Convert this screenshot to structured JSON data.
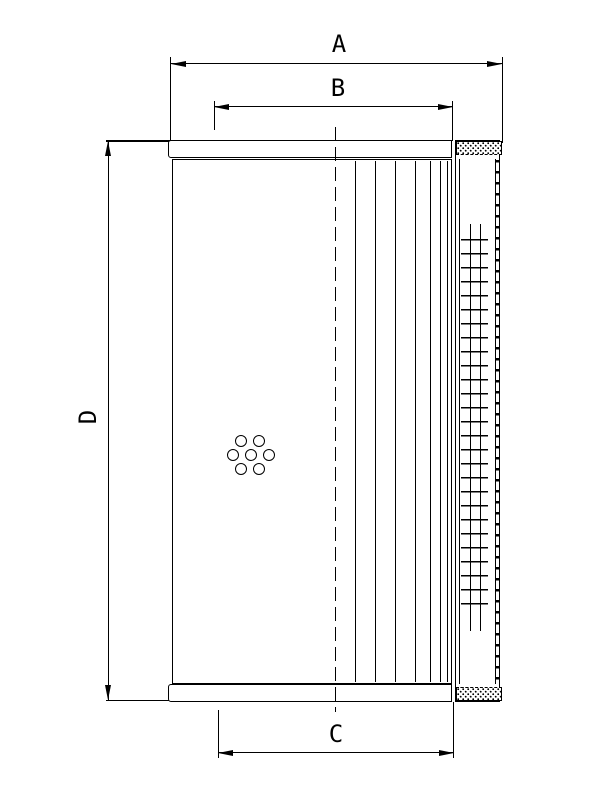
{
  "drawing": {
    "description": "filter-element-dimension-drawing",
    "labels": {
      "width_a": "A",
      "width_b": "B",
      "width_c": "C",
      "height_d": "D"
    },
    "colors": {
      "line": "#000000",
      "background": "#ffffff"
    }
  }
}
